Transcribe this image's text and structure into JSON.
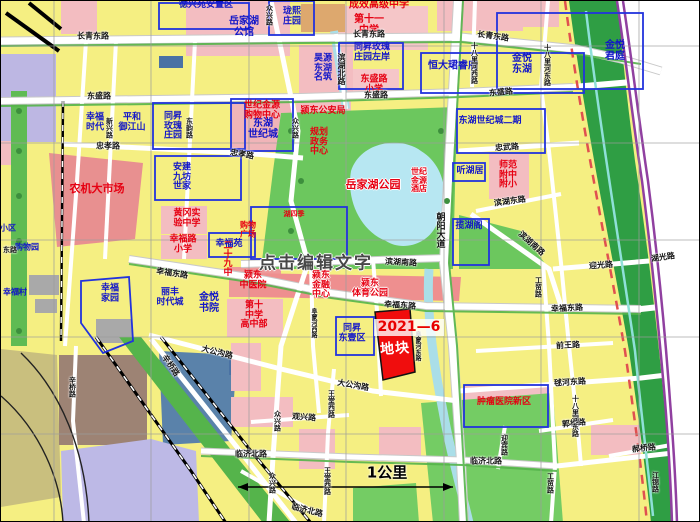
{
  "map": {
    "watermark": "点击编辑文字",
    "plot": {
      "code": "2021—6",
      "name": "地块"
    },
    "scale": {
      "label": "1公里"
    },
    "colors": {
      "block_yellow": "#f5ef82",
      "block_pink": "#f3bdc1",
      "block_salmon": "#ee8f8f",
      "park_green": "#6cc75e",
      "corridor_green": "#2f9e44",
      "water": "#b7e7f2",
      "lavender": "#bdb9e6",
      "olive": "#c9bf7e",
      "slate_blue": "#5a82aa",
      "brown": "#9d8374",
      "plot_red": "#f00d0d",
      "compound_border_blue": "#2233dd",
      "expressway_purple": "#9040a0",
      "label_blue": "#1216c8",
      "label_red": "#e60012"
    },
    "labels": [
      {
        "t": "德兴苑安置区",
        "x": 205,
        "y": 5,
        "c": "blue",
        "s": 9
      },
      {
        "t": "岳家湖\n公馆",
        "x": 243,
        "y": 27,
        "c": "blue",
        "s": 10
      },
      {
        "t": "珑熙\n庄园",
        "x": 291,
        "y": 16,
        "c": "blue",
        "s": 9
      },
      {
        "t": "同昇玫瑰\n庄园左岸",
        "x": 371,
        "y": 52,
        "c": "blue",
        "s": 9
      },
      {
        "t": "金悦\n东湖",
        "x": 521,
        "y": 64,
        "c": "blue",
        "s": 10
      },
      {
        "t": "金悦\n君庭",
        "x": 614,
        "y": 51,
        "c": "blue",
        "s": 10
      },
      {
        "t": "昊源\n东湖\n名筑",
        "x": 322,
        "y": 68,
        "c": "blue",
        "s": 9
      },
      {
        "t": "恒大珺睿府",
        "x": 452,
        "y": 66,
        "c": "blue",
        "s": 10
      },
      {
        "t": "幸福\n时代",
        "x": 94,
        "y": 122,
        "c": "blue",
        "s": 9
      },
      {
        "t": "平和\n御江山",
        "x": 131,
        "y": 122,
        "c": "blue",
        "s": 9
      },
      {
        "t": "同昇\n玫瑰\n庄园",
        "x": 172,
        "y": 126,
        "c": "blue",
        "s": 9
      },
      {
        "t": "东湖\n世纪城",
        "x": 262,
        "y": 129,
        "c": "blue",
        "s": 10
      },
      {
        "t": "安建\n九坊\n世家",
        "x": 181,
        "y": 177,
        "c": "blue",
        "s": 9
      },
      {
        "t": "东湖世纪城二期",
        "x": 489,
        "y": 121,
        "c": "blue",
        "s": 9
      },
      {
        "t": "听湖居",
        "x": 469,
        "y": 171,
        "c": "blue",
        "s": 9
      },
      {
        "t": "揽湖阁",
        "x": 468,
        "y": 226,
        "c": "blue",
        "s": 9
      },
      {
        "t": "幸福苑",
        "x": 228,
        "y": 244,
        "c": "blue",
        "s": 9
      },
      {
        "t": "丽丰\n时代城",
        "x": 169,
        "y": 297,
        "c": "blue",
        "s": 9
      },
      {
        "t": "金悦\n书院",
        "x": 208,
        "y": 303,
        "c": "blue",
        "s": 10
      },
      {
        "t": "幸福\n家园",
        "x": 109,
        "y": 293,
        "c": "blue",
        "s": 9
      },
      {
        "t": "同昇\n东壹区",
        "x": 351,
        "y": 333,
        "c": "blue",
        "s": 9
      },
      {
        "t": "幸福村",
        "x": 14,
        "y": 292,
        "c": "blue",
        "s": 8
      },
      {
        "t": "小区",
        "x": 7,
        "y": 228,
        "c": "blue",
        "s": 8
      },
      {
        "t": "购物园",
        "x": 26,
        "y": 247,
        "c": "blue",
        "s": 8
      },
      {
        "t": "第十一\n中学",
        "x": 368,
        "y": 25,
        "c": "red",
        "s": 10
      },
      {
        "t": "成效高级中学",
        "x": 378,
        "y": 5,
        "c": "red",
        "s": 10
      },
      {
        "t": "东盛路\n小学",
        "x": 373,
        "y": 84,
        "c": "red",
        "s": 9
      },
      {
        "t": "世纪金源\n购物中心",
        "x": 261,
        "y": 110,
        "c": "red",
        "s": 9
      },
      {
        "t": "颍东公安局",
        "x": 322,
        "y": 111,
        "c": "red",
        "s": 9
      },
      {
        "t": "规划\n政务\n中心",
        "x": 318,
        "y": 142,
        "c": "red",
        "s": 9
      },
      {
        "t": "岳家湖公园",
        "x": 372,
        "y": 184,
        "c": "red outl",
        "s": 11
      },
      {
        "t": "世纪\n金源\n酒店",
        "x": 418,
        "y": 180,
        "c": "red outl",
        "s": 8
      },
      {
        "t": "师范\n附中\n附小",
        "x": 507,
        "y": 175,
        "c": "red",
        "s": 9
      },
      {
        "t": "农机大市场",
        "x": 96,
        "y": 188,
        "c": "red",
        "s": 11
      },
      {
        "t": "黄冈实\n验中学",
        "x": 186,
        "y": 218,
        "c": "red",
        "s": 9
      },
      {
        "t": "幸福路\n小学",
        "x": 182,
        "y": 244,
        "c": "red",
        "s": 9
      },
      {
        "t": "二十九中",
        "x": 225,
        "y": 257,
        "c": "red",
        "s": 9,
        "v": 1
      },
      {
        "t": "购物\n广场",
        "x": 247,
        "y": 229,
        "c": "red",
        "s": 8
      },
      {
        "t": "湖四季",
        "x": 293,
        "y": 214,
        "c": "red",
        "s": 7
      },
      {
        "t": "颍东\n中医院",
        "x": 252,
        "y": 280,
        "c": "red",
        "s": 9
      },
      {
        "t": "颍东\n金融\n中心",
        "x": 320,
        "y": 285,
        "c": "red outl",
        "s": 9
      },
      {
        "t": "颍东\n体育公园",
        "x": 369,
        "y": 288,
        "c": "red outl",
        "s": 9
      },
      {
        "t": "第十\n中学\n高中部",
        "x": 253,
        "y": 315,
        "c": "red",
        "s": 9
      },
      {
        "t": "肿瘤医院新区",
        "x": 503,
        "y": 402,
        "c": "red",
        "s": 9
      },
      {
        "t": "长青东路",
        "x": 92,
        "y": 36,
        "c": "road",
        "s": 8
      },
      {
        "t": "长青东路",
        "x": 368,
        "y": 34,
        "c": "road",
        "s": 8
      },
      {
        "t": "长青东路",
        "x": 492,
        "y": 36,
        "c": "road",
        "s": 8,
        "r": 8
      },
      {
        "t": "东盛路",
        "x": 98,
        "y": 96,
        "c": "road",
        "s": 8
      },
      {
        "t": "东盛路",
        "x": 375,
        "y": 95,
        "c": "road",
        "s": 8
      },
      {
        "t": "东盛路",
        "x": 500,
        "y": 92,
        "c": "road",
        "s": 8,
        "r": -5
      },
      {
        "t": "忠孝路",
        "x": 107,
        "y": 146,
        "c": "road",
        "s": 8
      },
      {
        "t": "忠孝路",
        "x": 241,
        "y": 154,
        "c": "road",
        "s": 8,
        "r": 10
      },
      {
        "t": "忠武路",
        "x": 506,
        "y": 147,
        "c": "road",
        "s": 8,
        "r": -4
      },
      {
        "t": "十八里河西路",
        "x": 473,
        "y": 62,
        "c": "road",
        "s": 7,
        "v": 1
      },
      {
        "t": "十八里河东路",
        "x": 546,
        "y": 64,
        "c": "road",
        "s": 7,
        "v": 1
      },
      {
        "t": "滨湖北路",
        "x": 340,
        "y": 68,
        "c": "road",
        "s": 8,
        "v": 1
      },
      {
        "t": "众兴路",
        "x": 268,
        "y": 14,
        "c": "road",
        "s": 7,
        "v": 1
      },
      {
        "t": "众兴路",
        "x": 294,
        "y": 127,
        "c": "road",
        "s": 7,
        "v": 1
      },
      {
        "t": "众兴路",
        "x": 276,
        "y": 420,
        "c": "road",
        "s": 7,
        "v": 1
      },
      {
        "t": "众兴路",
        "x": 271,
        "y": 482,
        "c": "road",
        "s": 7,
        "v": 1
      },
      {
        "t": "新兴路",
        "x": 108,
        "y": 127,
        "c": "road",
        "s": 7,
        "v": 1
      },
      {
        "t": "东韵路",
        "x": 188,
        "y": 127,
        "c": "road",
        "s": 7,
        "v": 1
      },
      {
        "t": "滨湖东路",
        "x": 509,
        "y": 201,
        "c": "road",
        "s": 8,
        "r": -8
      },
      {
        "t": "滨湖南路",
        "x": 400,
        "y": 262,
        "c": "road",
        "s": 8,
        "r": 3
      },
      {
        "t": "滨湖南路",
        "x": 530,
        "y": 243,
        "c": "road",
        "s": 8,
        "r": 42
      },
      {
        "t": "朝阳大道",
        "x": 438,
        "y": 229,
        "c": "road",
        "s": 9,
        "v": 1
      },
      {
        "t": "迎光路",
        "x": 600,
        "y": 265,
        "c": "road",
        "s": 8,
        "r": -4
      },
      {
        "t": "湖光路",
        "x": 662,
        "y": 257,
        "c": "road",
        "s": 8,
        "r": -8
      },
      {
        "t": "幸福东路",
        "x": 171,
        "y": 273,
        "c": "road",
        "s": 8,
        "r": 9
      },
      {
        "t": "幸福东路",
        "x": 399,
        "y": 305,
        "c": "road",
        "s": 8,
        "r": 4
      },
      {
        "t": "幸福东路",
        "x": 566,
        "y": 308,
        "c": "road",
        "s": 8,
        "r": -3
      },
      {
        "t": "工贸路",
        "x": 537,
        "y": 286,
        "c": "road",
        "s": 7,
        "v": 1
      },
      {
        "t": "工贸路",
        "x": 549,
        "y": 482,
        "c": "road",
        "s": 7,
        "v": 1
      },
      {
        "t": "前王路",
        "x": 567,
        "y": 345,
        "c": "road",
        "s": 8,
        "r": -3
      },
      {
        "t": "毬河东路",
        "x": 569,
        "y": 382,
        "c": "road",
        "s": 8,
        "r": -4
      },
      {
        "t": "郭桥路",
        "x": 573,
        "y": 423,
        "c": "road",
        "s": 8,
        "r": -6
      },
      {
        "t": "郝桥路",
        "x": 643,
        "y": 448,
        "c": "road",
        "s": 8,
        "r": -6
      },
      {
        "t": "十八里河东路",
        "x": 574,
        "y": 415,
        "c": "road",
        "s": 7,
        "v": 1
      },
      {
        "t": "临济北路",
        "x": 250,
        "y": 454,
        "c": "road",
        "s": 8
      },
      {
        "t": "临济北路",
        "x": 485,
        "y": 461,
        "c": "road",
        "s": 8
      },
      {
        "t": "临济北路",
        "x": 306,
        "y": 510,
        "c": "road",
        "s": 8,
        "r": 14
      },
      {
        "t": "迎宾路",
        "x": 503,
        "y": 444,
        "c": "road",
        "s": 7,
        "v": 1
      },
      {
        "t": "江锦路",
        "x": 654,
        "y": 481,
        "c": "road",
        "s": 7,
        "v": 1
      },
      {
        "t": "大公沟路",
        "x": 216,
        "y": 352,
        "c": "road",
        "s": 8,
        "r": 14
      },
      {
        "t": "大公沟路",
        "x": 352,
        "y": 385,
        "c": "road",
        "s": 8,
        "r": 10
      },
      {
        "t": "观兴路",
        "x": 303,
        "y": 417,
        "c": "road",
        "s": 8,
        "r": 4
      },
      {
        "t": "王堂西路",
        "x": 330,
        "y": 403,
        "c": "road",
        "s": 7,
        "v": 1
      },
      {
        "t": "王堂西路",
        "x": 326,
        "y": 480,
        "c": "road",
        "s": 7,
        "v": 1
      },
      {
        "t": "辛桥路",
        "x": 71,
        "y": 386,
        "c": "road",
        "s": 7,
        "v": 1
      },
      {
        "t": "辛桥路",
        "x": 169,
        "y": 365,
        "c": "road",
        "s": 8,
        "r": 55
      },
      {
        "t": "阜蒙河西路",
        "x": 312,
        "y": 322,
        "c": "road",
        "s": 6,
        "v": 1
      },
      {
        "t": "阜蒙河东路",
        "x": 416,
        "y": 345,
        "c": "road",
        "s": 6,
        "v": 1
      },
      {
        "t": "东路",
        "x": 9,
        "y": 250,
        "c": "road",
        "s": 7
      }
    ]
  }
}
